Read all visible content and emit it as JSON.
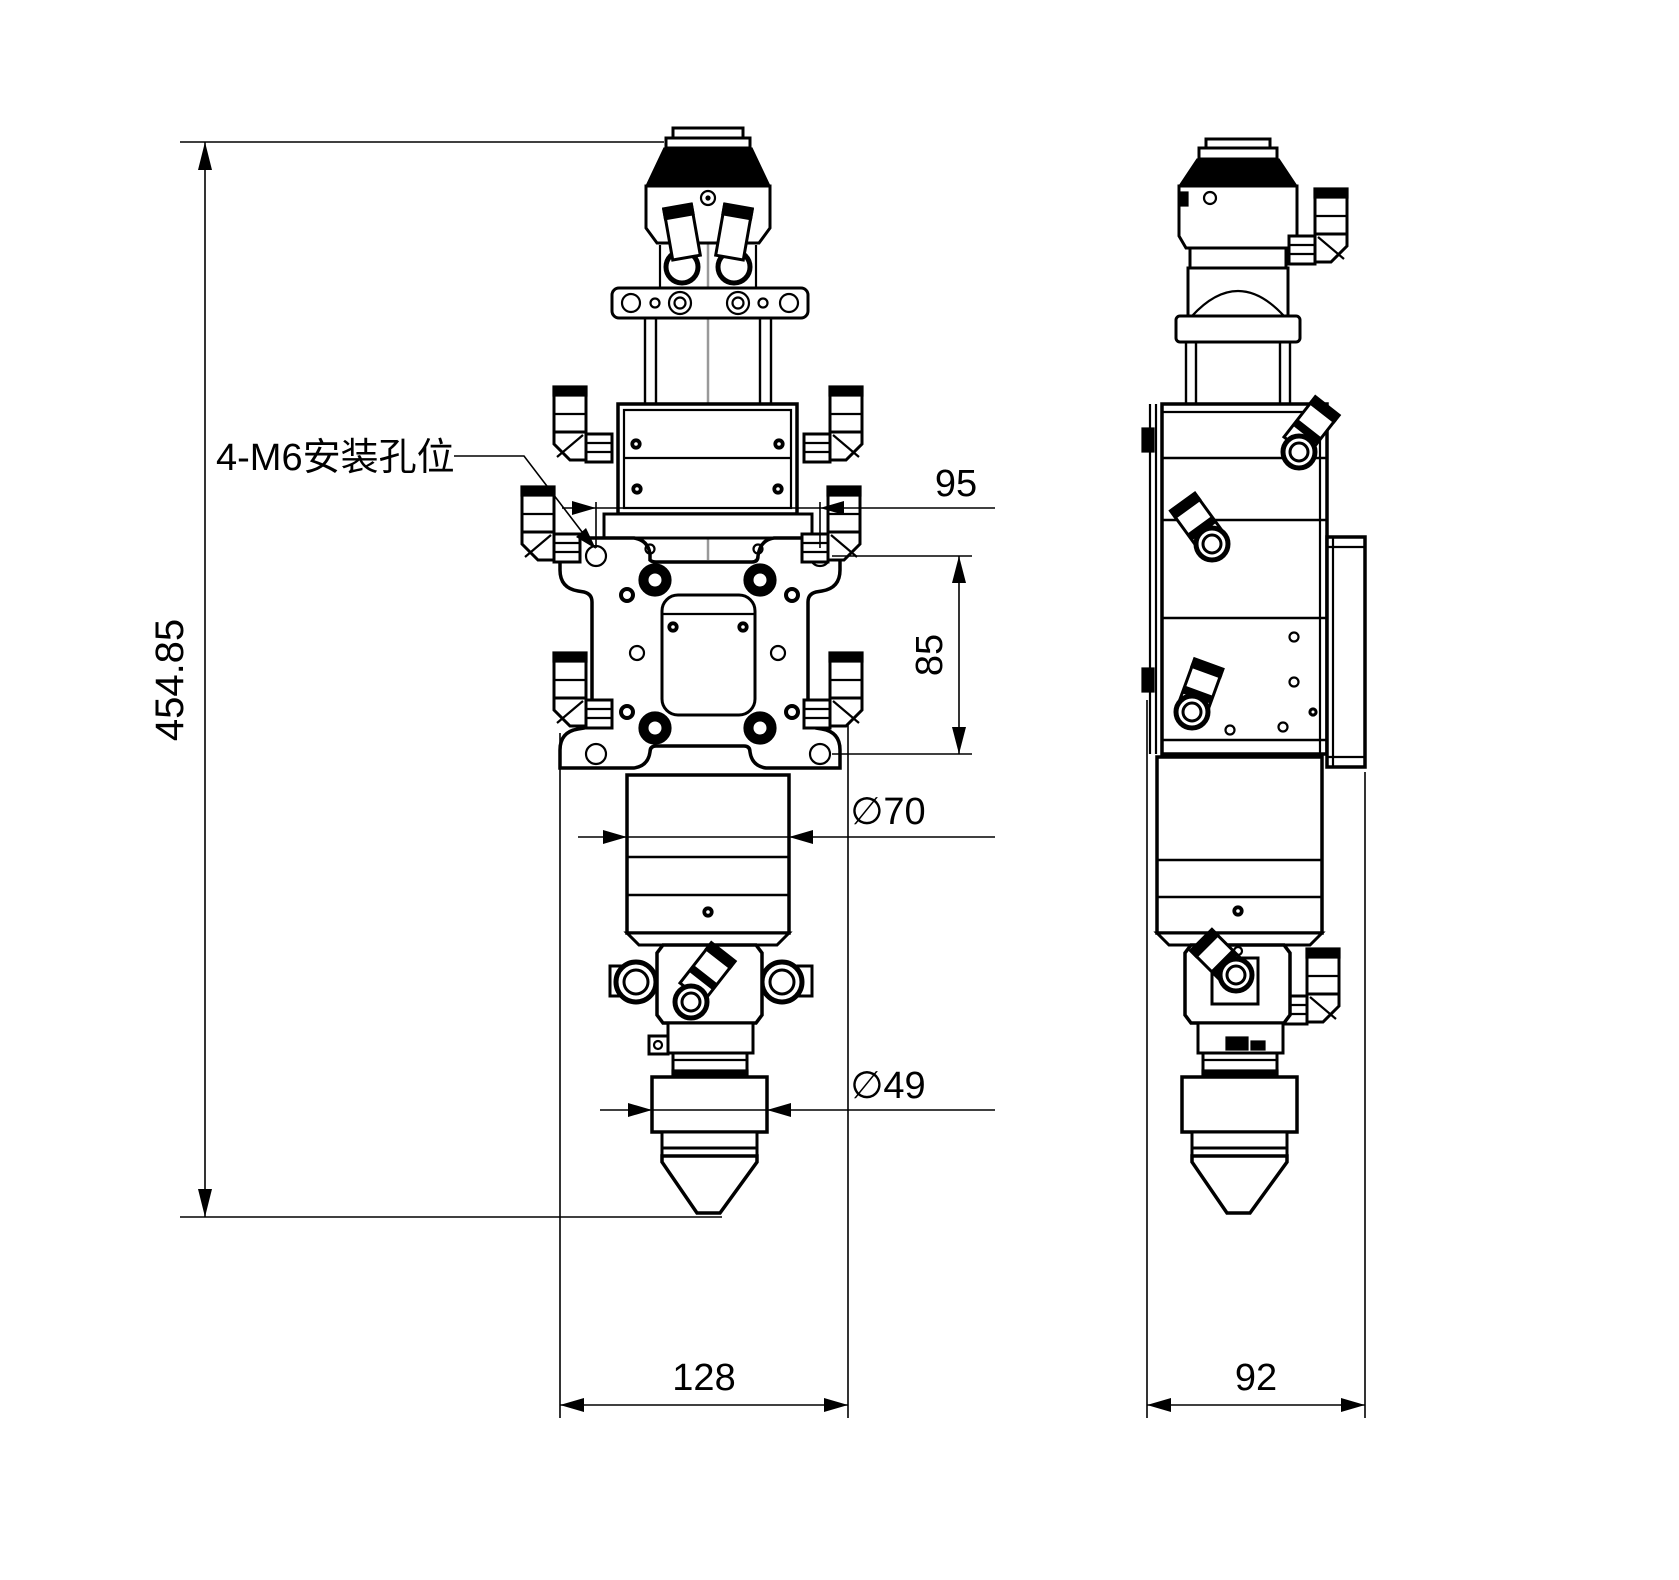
{
  "colors": {
    "background": "#ffffff",
    "line": "#000000",
    "centerline": "#999999"
  },
  "annotations": {
    "mounting_holes_label": "4-M6安装孔位",
    "overall_height": "454.85",
    "hole_spacing_horizontal": "95",
    "hole_spacing_vertical": "85",
    "body_diameter": "∅70",
    "nozzle_diameter": "∅49",
    "front_width": "128",
    "side_width": "92"
  }
}
